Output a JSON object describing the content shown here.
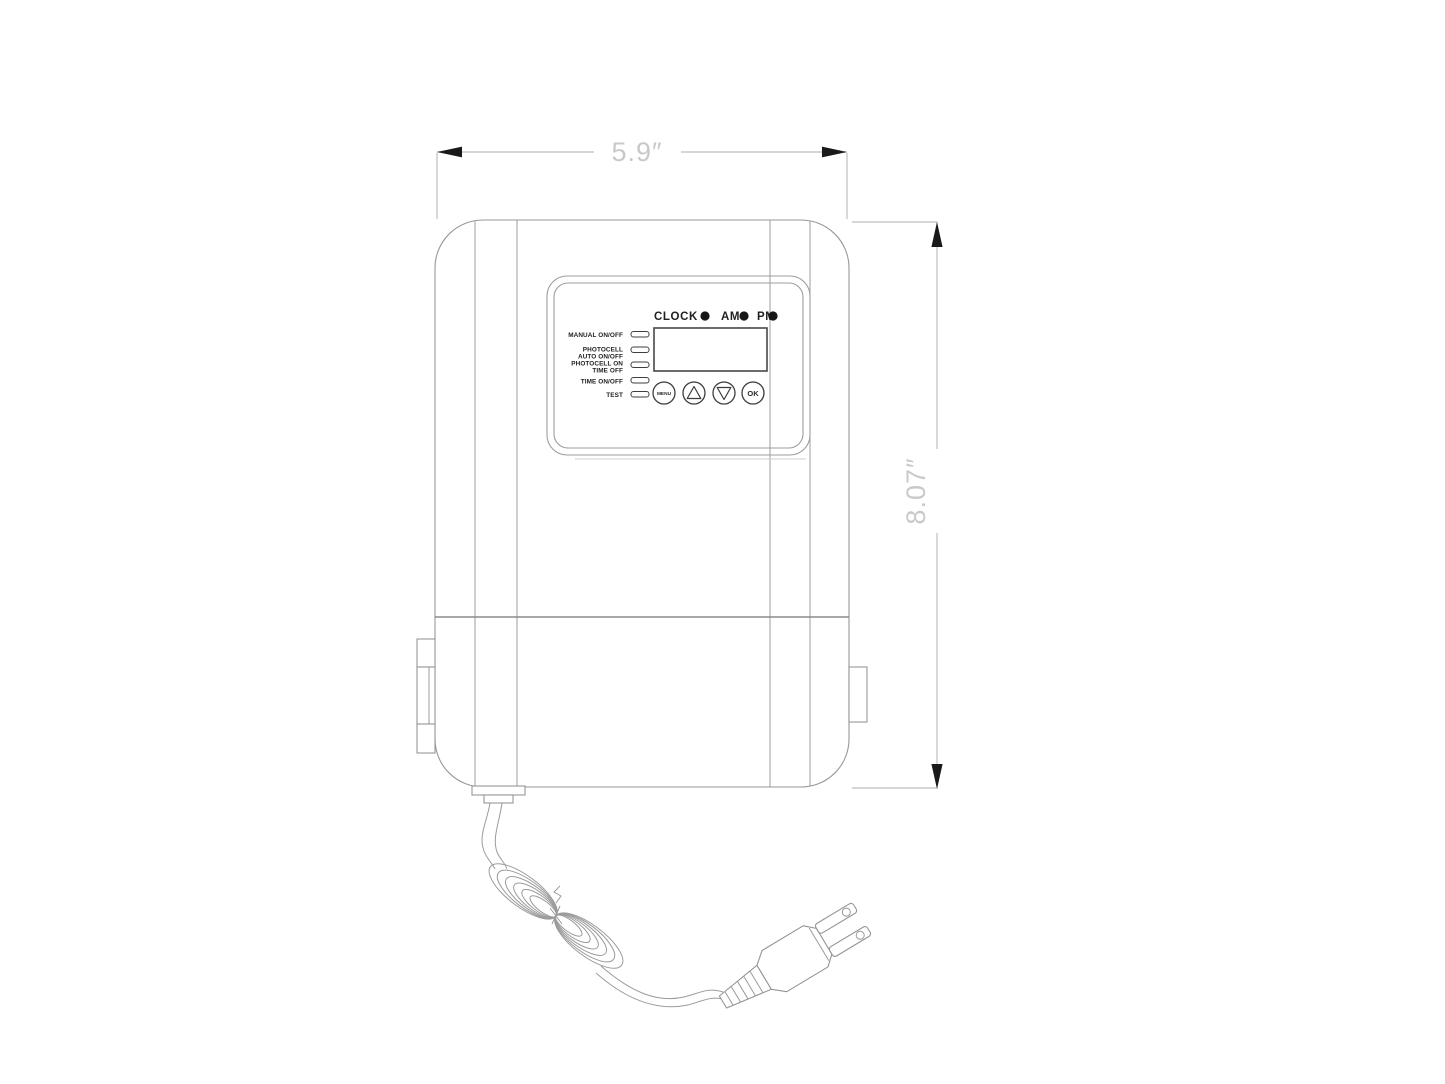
{
  "colors": {
    "background": "#ffffff",
    "drawing_line": "#979797",
    "panel_ink": "#1f1f1f",
    "dimension_line": "#bdbdbd",
    "dimension_arrow": "#1a1a1a",
    "dimension_text": "#c9c9c9"
  },
  "dimensions": {
    "width_label": "5.9″",
    "height_label": "8.07″"
  },
  "panel": {
    "clock_label": "CLOCK",
    "am_label": "AM",
    "pm_label": "PM",
    "indicators": [
      {
        "lines": [
          "MANUAL ON/OFF"
        ]
      },
      {
        "lines": [
          "PHOTOCELL",
          "AUTO ON/OFF"
        ]
      },
      {
        "lines": [
          "PHOTOCELL ON",
          "TIME OFF"
        ]
      },
      {
        "lines": [
          "TIME ON/OFF"
        ]
      },
      {
        "lines": [
          "TEST"
        ]
      }
    ],
    "menu_button_label": "MENU",
    "ok_button_label": "OK"
  }
}
